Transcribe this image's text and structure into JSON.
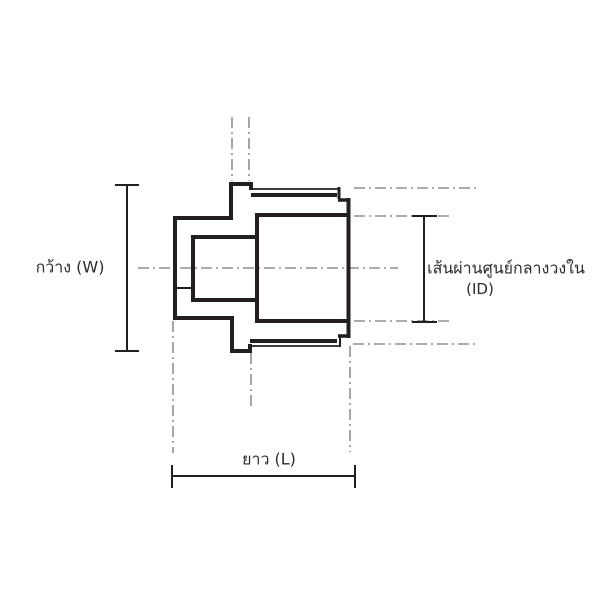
{
  "diagram": {
    "labels": {
      "width": "กว้าง (W)",
      "inner_diameter": "เส้นผ่านศูนย์กลางวงใน",
      "inner_diameter_abbr": "(ID)",
      "length": "ยาว (L)"
    },
    "colors": {
      "outline": "#231f20",
      "centerline": "#8f8f8f",
      "text": "#2b2b2b",
      "background": "#ffffff"
    }
  }
}
